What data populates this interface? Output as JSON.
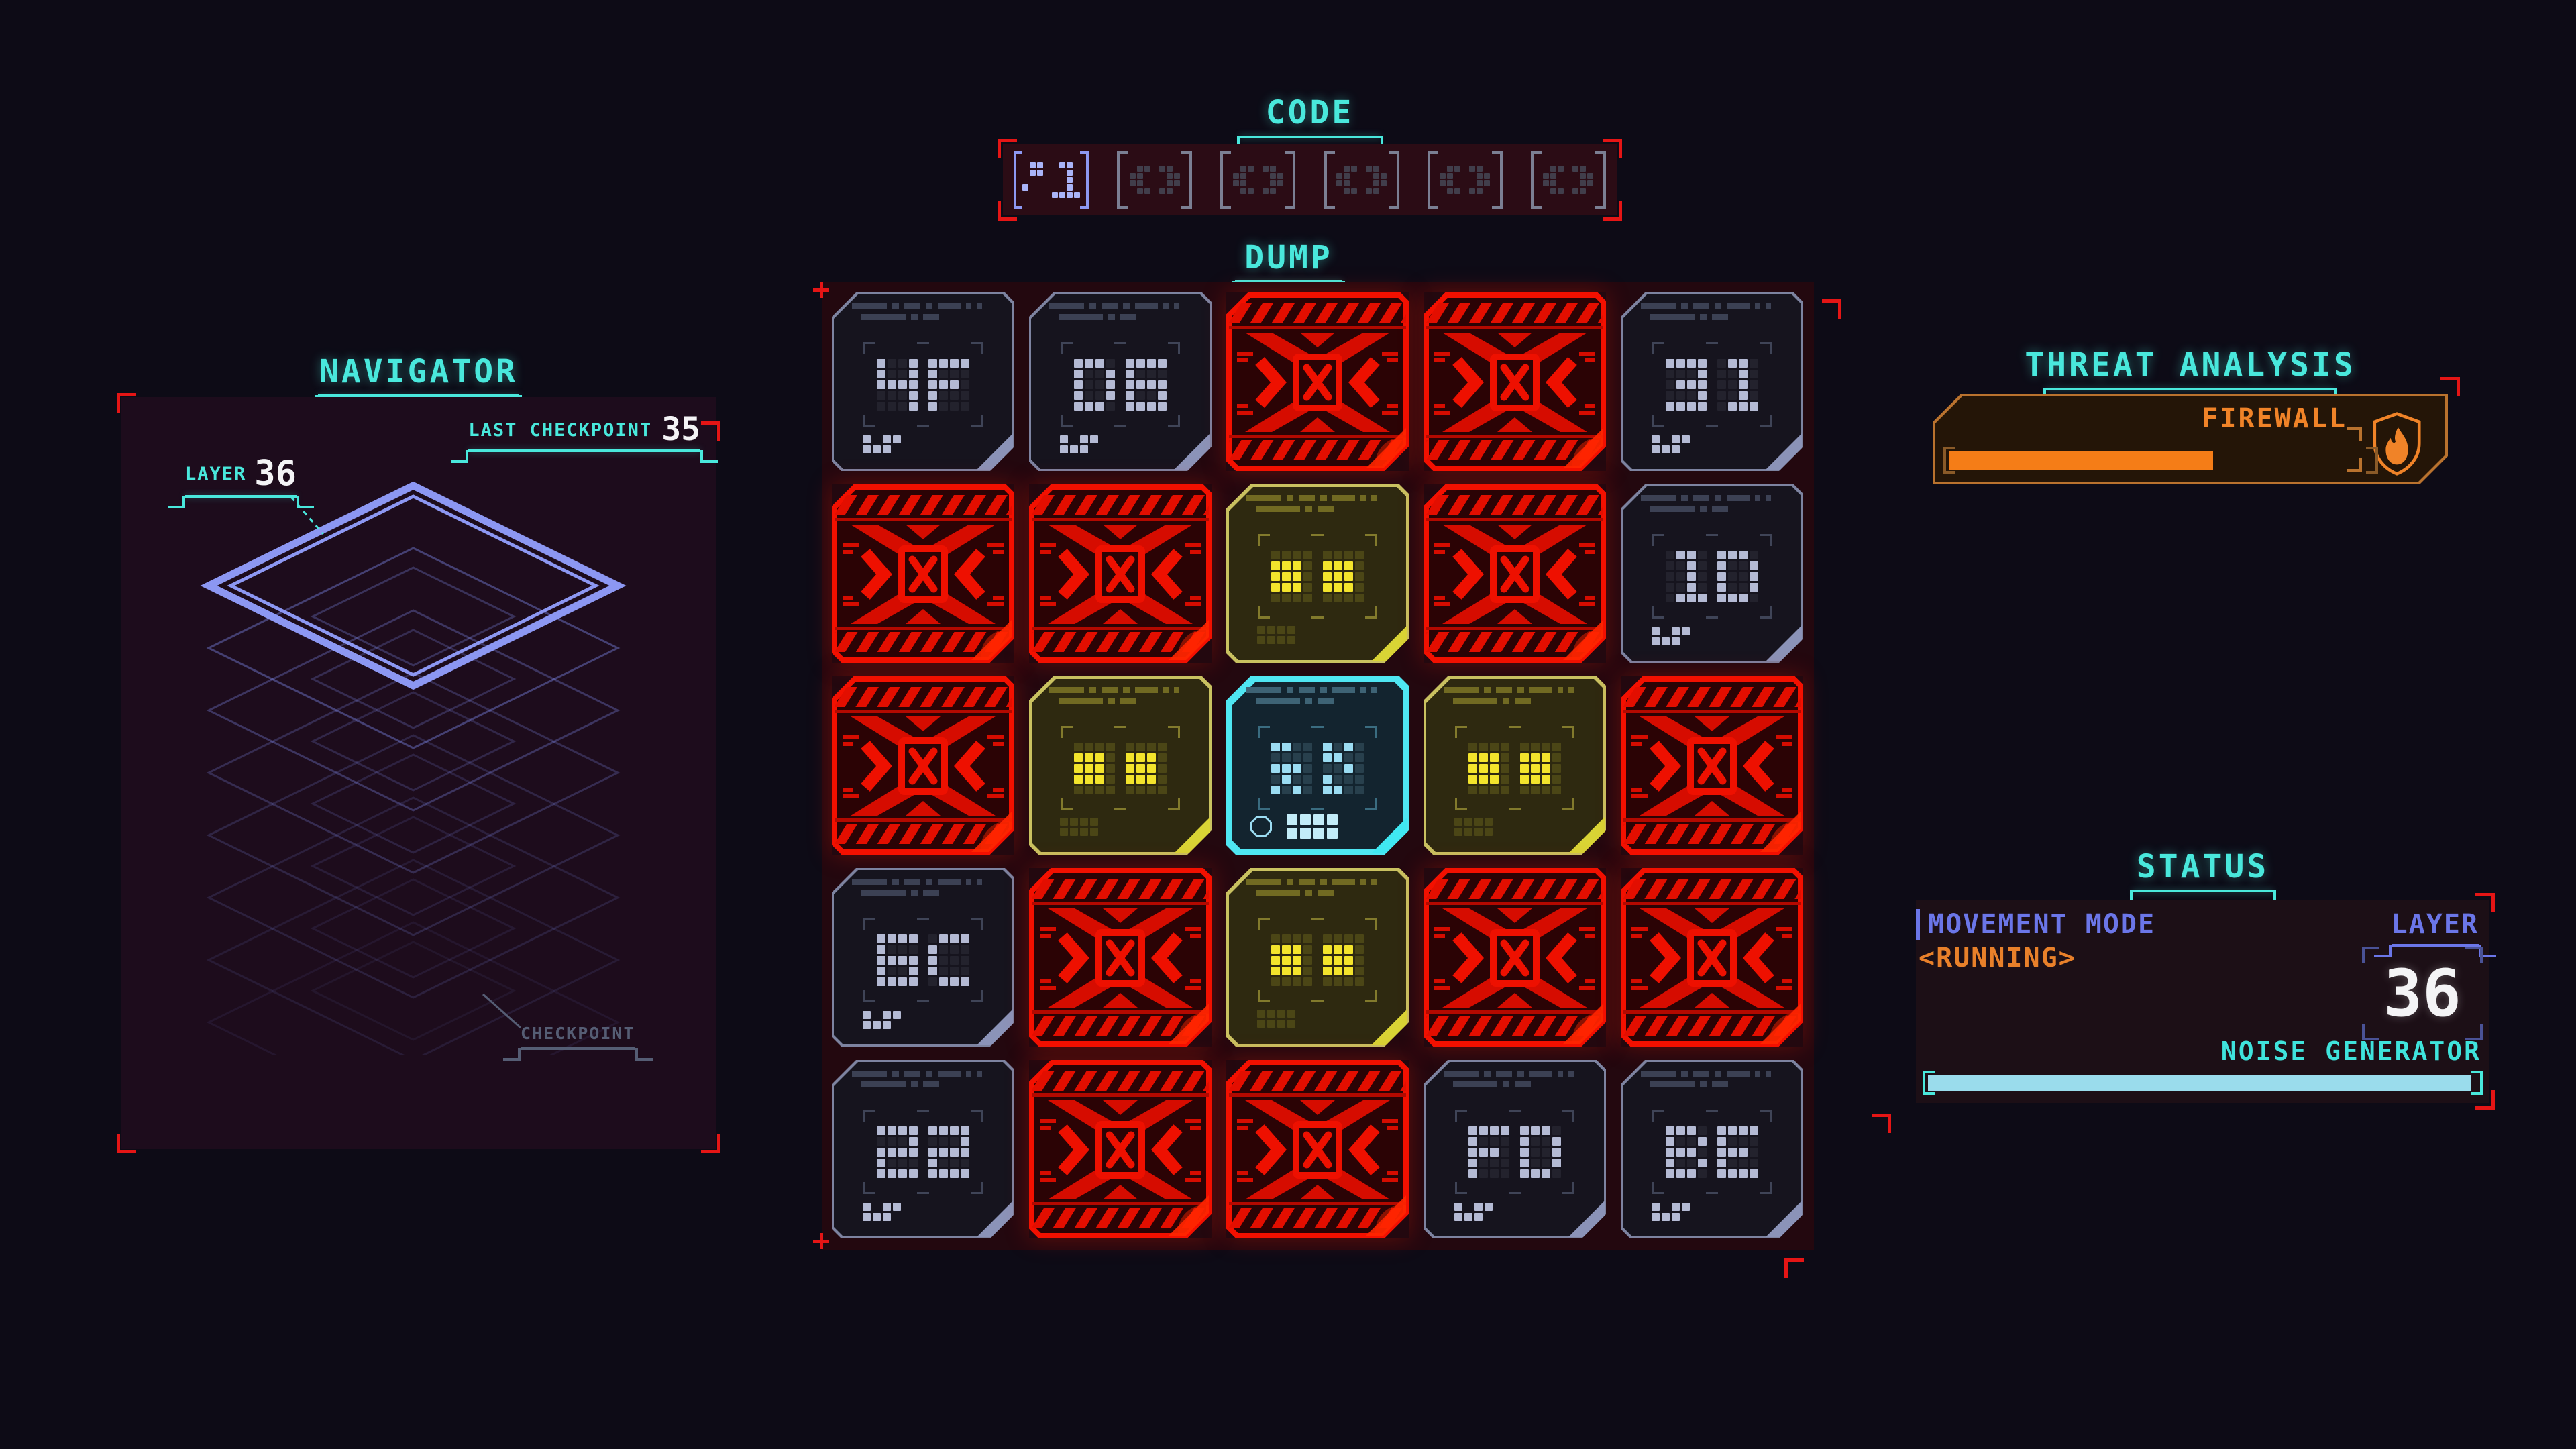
{
  "app": {
    "background": "#0d0b16"
  },
  "colors": {
    "accent_cyan": "#49e8dc",
    "accent_periwinkle": "#6b76e8",
    "accent_orange": "#f08328",
    "threat_red": "#ee1000",
    "masked_yellow": "#f3e42c",
    "player_cyan": "#4fe6f2",
    "value_white": "#f4f4f6"
  },
  "code": {
    "title": "CODE",
    "slots": [
      {
        "state": "filled"
      },
      {
        "state": "empty"
      },
      {
        "state": "empty"
      },
      {
        "state": "empty"
      },
      {
        "state": "empty"
      },
      {
        "state": "empty"
      }
    ]
  },
  "dump": {
    "title": "DUMP",
    "rows": 5,
    "cols": 5,
    "tiles": [
      {
        "type": "data",
        "value": "4F"
      },
      {
        "type": "data",
        "value": "D6"
      },
      {
        "type": "threat"
      },
      {
        "type": "threat"
      },
      {
        "type": "data",
        "value": "31"
      },
      {
        "type": "threat"
      },
      {
        "type": "threat"
      },
      {
        "type": "masked"
      },
      {
        "type": "threat"
      },
      {
        "type": "data",
        "value": "1D"
      },
      {
        "type": "threat"
      },
      {
        "type": "masked"
      },
      {
        "type": "player"
      },
      {
        "type": "masked"
      },
      {
        "type": "threat"
      },
      {
        "type": "data",
        "value": "6C"
      },
      {
        "type": "threat"
      },
      {
        "type": "masked"
      },
      {
        "type": "threat"
      },
      {
        "type": "threat"
      },
      {
        "type": "data",
        "value": "22"
      },
      {
        "type": "threat"
      },
      {
        "type": "threat"
      },
      {
        "type": "data",
        "value": "FD"
      },
      {
        "type": "data",
        "value": "BE"
      }
    ]
  },
  "navigator": {
    "title": "NAVIGATOR",
    "last_checkpoint_label": "LAST CHECKPOINT",
    "last_checkpoint_value": "35",
    "layer_label": "LAYER",
    "layer_value": "36",
    "checkpoint_label": "CHECKPOINT"
  },
  "threat_analysis": {
    "title": "THREAT ANALYSIS",
    "firewall_label": "FIREWALL",
    "firewall_progress": 62
  },
  "status": {
    "title": "STATUS",
    "movement_mode_label": "MOVEMENT MODE",
    "movement_mode_value": "<RUNNING>",
    "layer_label": "LAYER",
    "layer_value": "36",
    "noise_label": "NOISE GENERATOR",
    "noise_progress": 98
  }
}
